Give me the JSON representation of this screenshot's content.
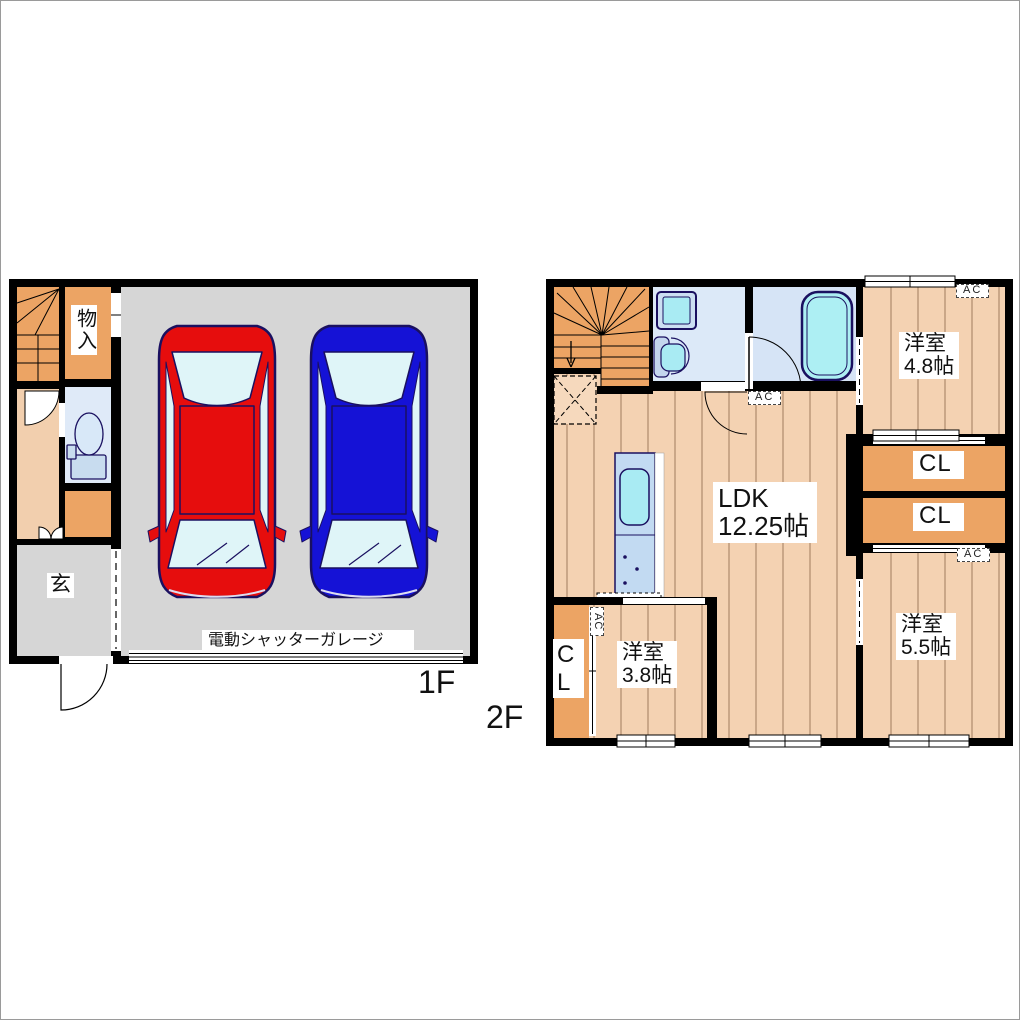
{
  "floor1": {
    "label": "1F",
    "storage": "物入",
    "entrance": "玄",
    "garage": "電動シャッターガレージ"
  },
  "floor2": {
    "label": "2F",
    "ldk": {
      "name": "LDK",
      "size": "12.25帖"
    },
    "room_4_8": {
      "name": "洋室",
      "size": "4.8帖"
    },
    "room_5_5": {
      "name": "洋室",
      "size": "5.5帖"
    },
    "room_3_8": {
      "name": "洋室",
      "size": "3.8帖"
    },
    "closets": [
      "CL",
      "CL",
      "CL"
    ],
    "ac": "AC"
  },
  "colors": {
    "wall": "#000000",
    "wood_floor": "#f4d2b2",
    "stair_orange": "#eca464",
    "garage_gray": "#d6d6d6",
    "hall_peach": "#f2cfae",
    "wet_room_blue": "#dce9f8",
    "fixture_cyan": "#a9ebf3",
    "kitchen_blue": "#c2daf2",
    "car_red": "#e60d0d",
    "car_blue": "#1512d6"
  }
}
